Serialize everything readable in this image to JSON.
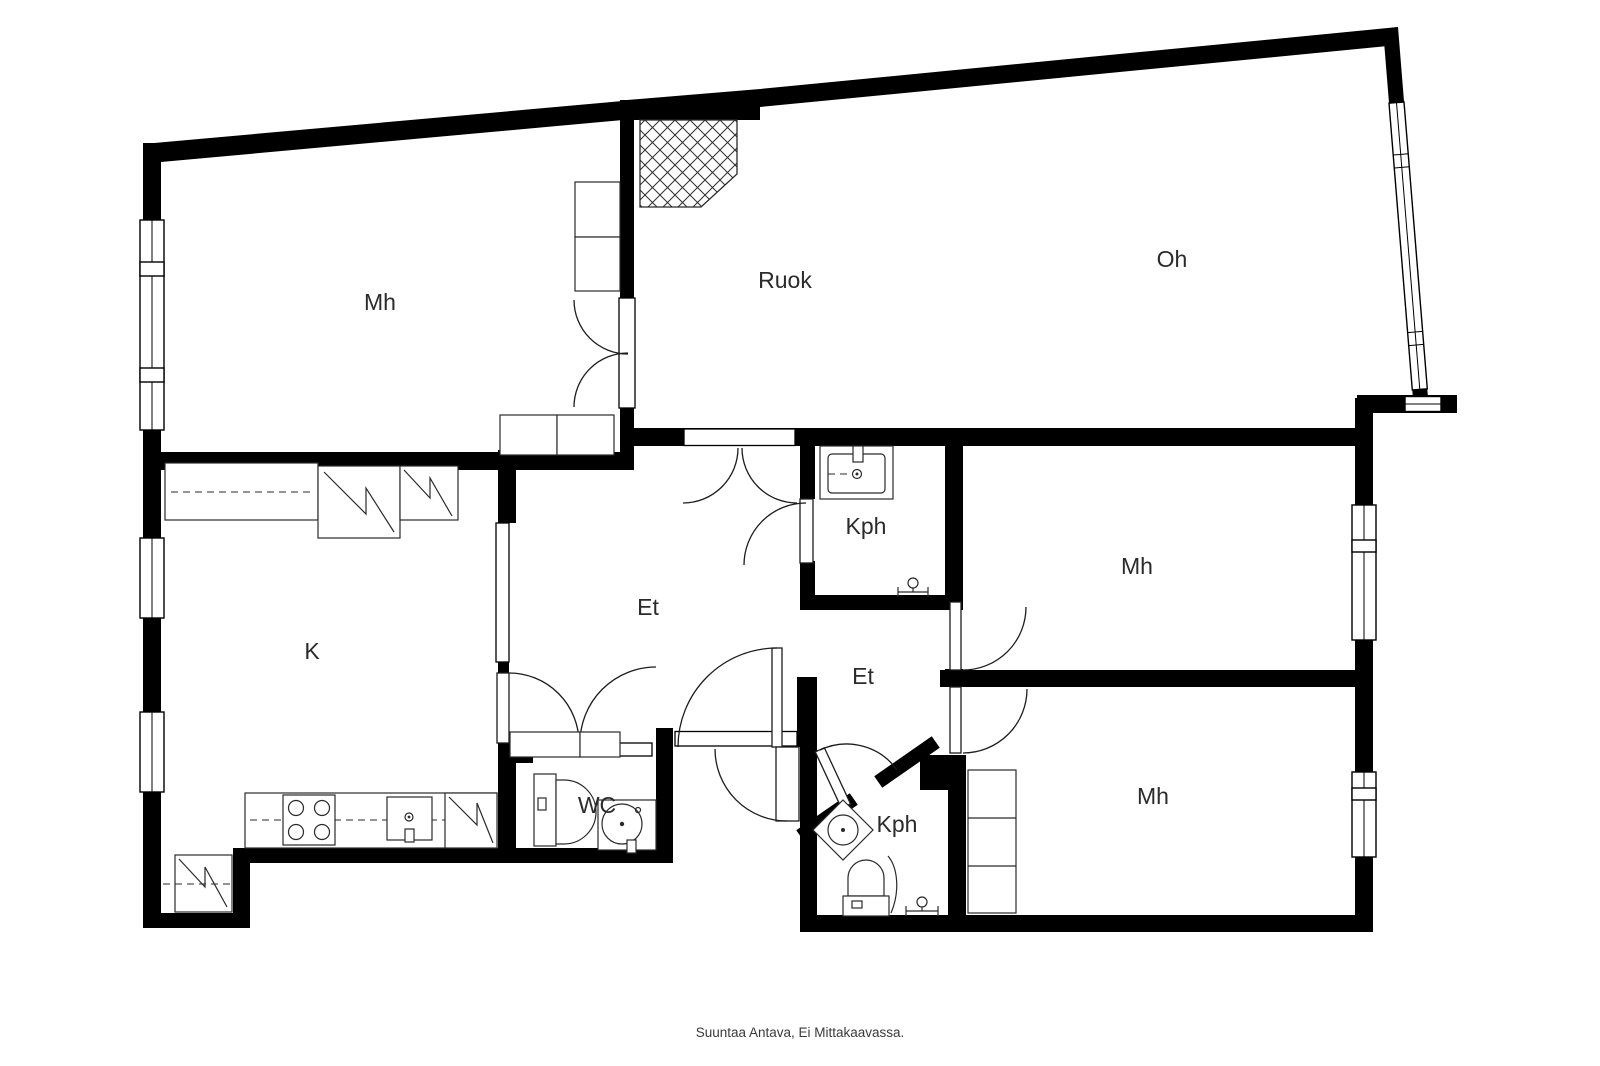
{
  "plan": {
    "title": "apartment-floor-plan",
    "footer": "Suuntaa Antava, Ei Mittakaavassa.",
    "wall_color": "#000000",
    "label_color": "#2b2b2b",
    "rooms": [
      {
        "id": "mh-top-left",
        "label": "Mh"
      },
      {
        "id": "ruok",
        "label": "Ruok"
      },
      {
        "id": "oh",
        "label": "Oh"
      },
      {
        "id": "kph-upper",
        "label": "Kph"
      },
      {
        "id": "mh-right-upper",
        "label": "Mh"
      },
      {
        "id": "k",
        "label": "K"
      },
      {
        "id": "et-main",
        "label": "Et"
      },
      {
        "id": "et-corridor",
        "label": "Et"
      },
      {
        "id": "wc",
        "label": "WC"
      },
      {
        "id": "kph-lower",
        "label": "Kph"
      },
      {
        "id": "mh-right-lower",
        "label": "Mh"
      }
    ]
  }
}
